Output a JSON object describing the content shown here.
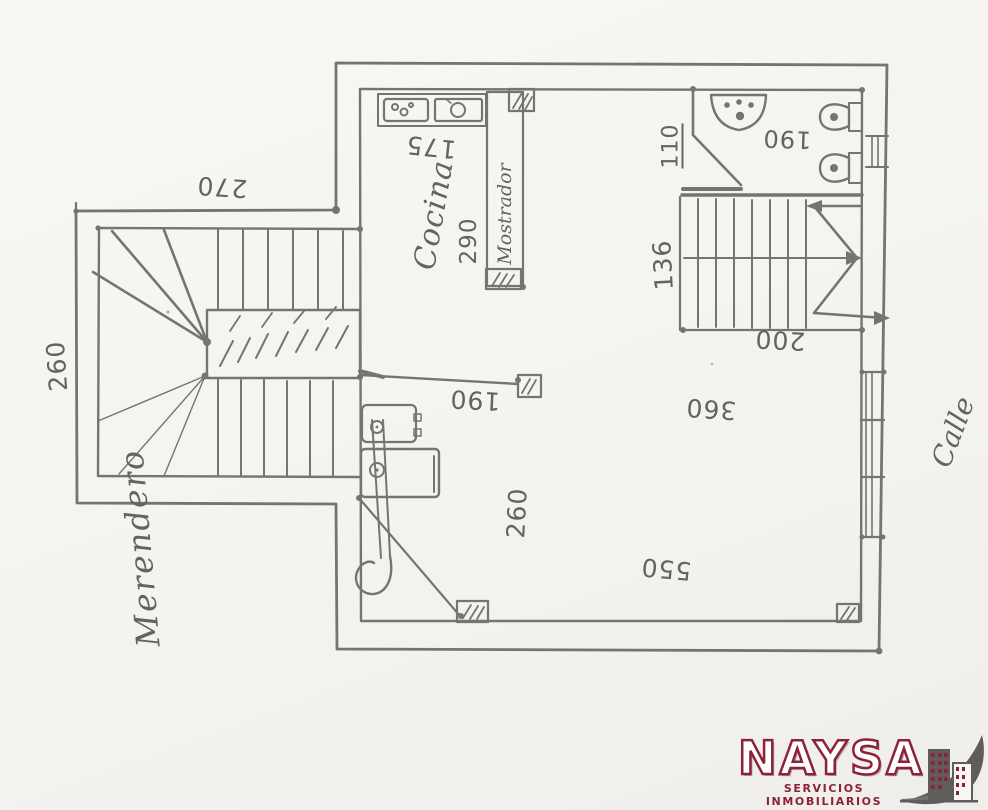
{
  "plan": {
    "room_labels": {
      "merendero": "Merendero",
      "cocina": "Cocina",
      "mostrador": "Mostrador",
      "calle": "Calle"
    },
    "dimensions": {
      "annex_width": "270",
      "annex_depth": "260",
      "kitchen_width": "175",
      "counter_length": "290",
      "bath_entry": "110",
      "bath_width": "190",
      "stair_width": "136",
      "stair_run": "200",
      "room_width": "360",
      "hall_width": "190",
      "room_mid_depth": "260",
      "room_length": "550"
    }
  },
  "logo": {
    "name": "NAYSA",
    "tagline": "SERVICIOS INMOBILIARIOS",
    "brand_red": "#8e2136",
    "brand_gray": "#66645f"
  },
  "colors": {
    "paper": "#f6f5f1",
    "pencil_ink": "#6c6b66"
  }
}
